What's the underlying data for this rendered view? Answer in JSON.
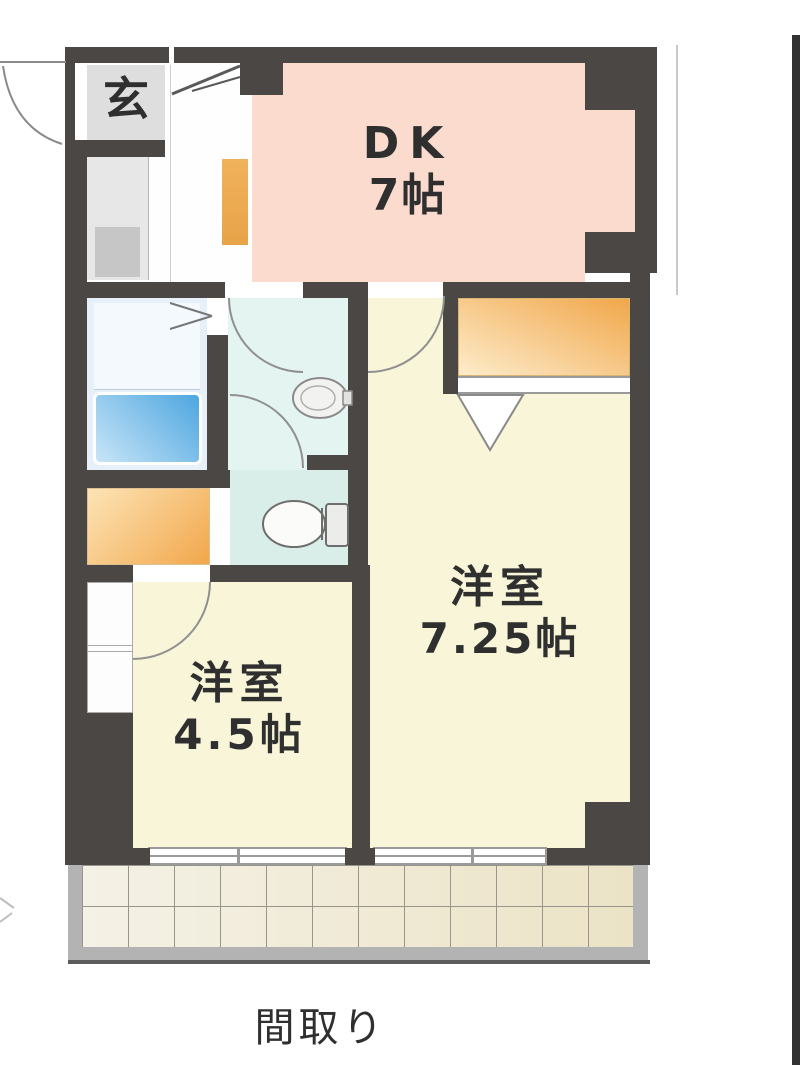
{
  "caption": "間取り",
  "rooms": {
    "entrance": {
      "label": "玄"
    },
    "dk": {
      "l1": "DK",
      "l2": "7帖"
    },
    "western1": {
      "l1": "洋室",
      "l2": "7.25帖"
    },
    "western2": {
      "l1": "洋室",
      "l2": "4.5帖"
    }
  },
  "icons": {
    "bathtub": "bathtub-icon",
    "toilet": "toilet-icon",
    "sink": "sink-icon",
    "door_arc": "door-swing-arc",
    "folding_door": "folding-door-icon",
    "entry_door": "entry-door-leaf"
  },
  "colors": {
    "wall": "#4b4745",
    "dk": "#fadbce",
    "room": "#f9f5d8",
    "hall": "#fefefe",
    "entrance-box": "#dedede",
    "kitchen": "#e7e7e7",
    "kitchen-sink": "#c6c6c6",
    "washroom": "#e4f4f0",
    "bathroom": "#e7f0f8",
    "bath-inner": "#f3f9fc",
    "toilet-room": "#d9eee8",
    "tub-dark": "#4ea6e0",
    "tub-light": "#c8e5f7",
    "closet-dark": "#f1a74b",
    "closet-light": "#fdeccb",
    "counter-dark": "#e8a348",
    "counter-light": "#f0b25c",
    "tile": "#efe8d2",
    "tile-grid": "#97968a",
    "frame": "#b3b3b3",
    "frameline": "#9a9a9a",
    "arc": "#909090",
    "edge-strip": "#323232",
    "text": "#2f2f2f"
  }
}
